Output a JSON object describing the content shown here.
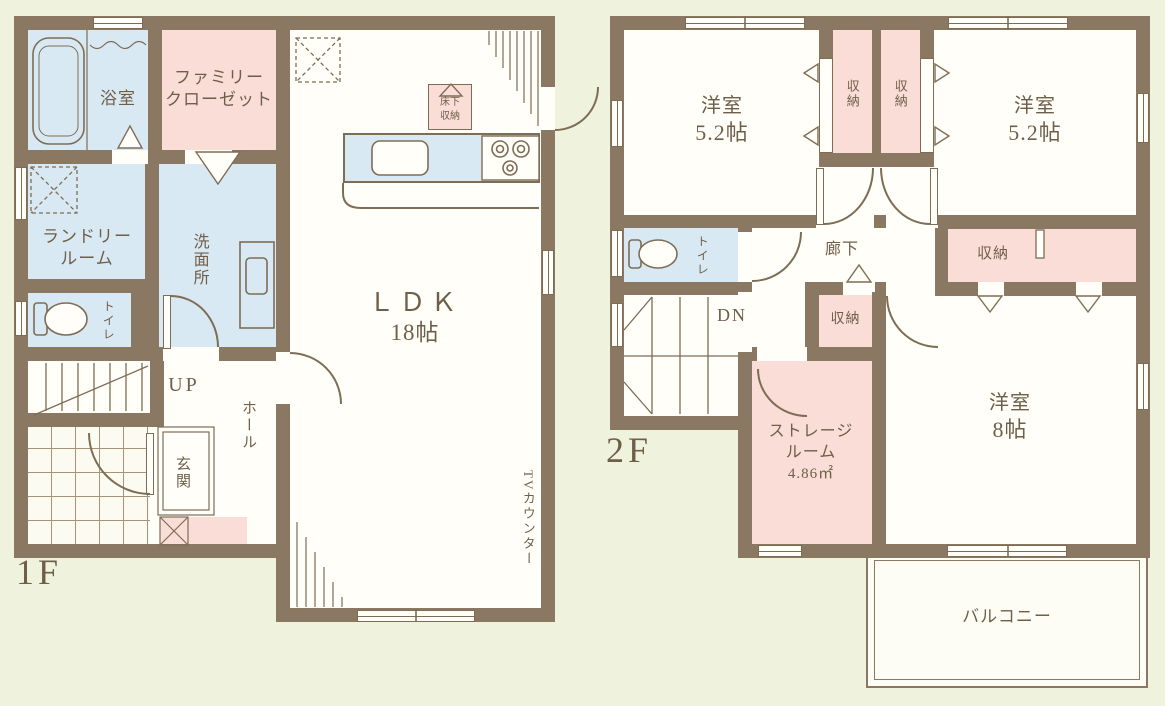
{
  "colors": {
    "bg": "#eff3de",
    "wall": "#8a7862",
    "line": "#7e6d55",
    "text": "#6f5f49",
    "room-white": "#fffef9",
    "room-blue": "#d9e9f4",
    "room-pink": "#f9ddd6"
  },
  "floor1": {
    "label": "1F",
    "bathroom": "浴室",
    "family_closet": [
      "ファミリー",
      "クローゼット"
    ],
    "laundry": [
      "ランドリー",
      "ルーム"
    ],
    "washroom": "洗面所",
    "toilet": "トイレ",
    "stairs": "UP",
    "hall": "ホール",
    "entrance": "玄関",
    "ldk": [
      "ＬＤＫ",
      "18帖"
    ],
    "underfloor_storage": [
      "床下",
      "収納"
    ],
    "tv_counter": "TVカウンター"
  },
  "floor2": {
    "label": "2F",
    "bedroom_a": [
      "洋室",
      "5.2帖"
    ],
    "bedroom_b": [
      "洋室",
      "5.2帖"
    ],
    "bedroom_c": [
      "洋室",
      "8帖"
    ],
    "closet_a": "収納",
    "closet_b": "収納",
    "closet_hall": "収納",
    "closet_c": "収納",
    "toilet": "トイレ",
    "stairs": "DN",
    "corridor": "廊下",
    "storage_room": [
      "ストレージ",
      "ルーム",
      "4.86㎡"
    ],
    "balcony": "バルコニー"
  }
}
